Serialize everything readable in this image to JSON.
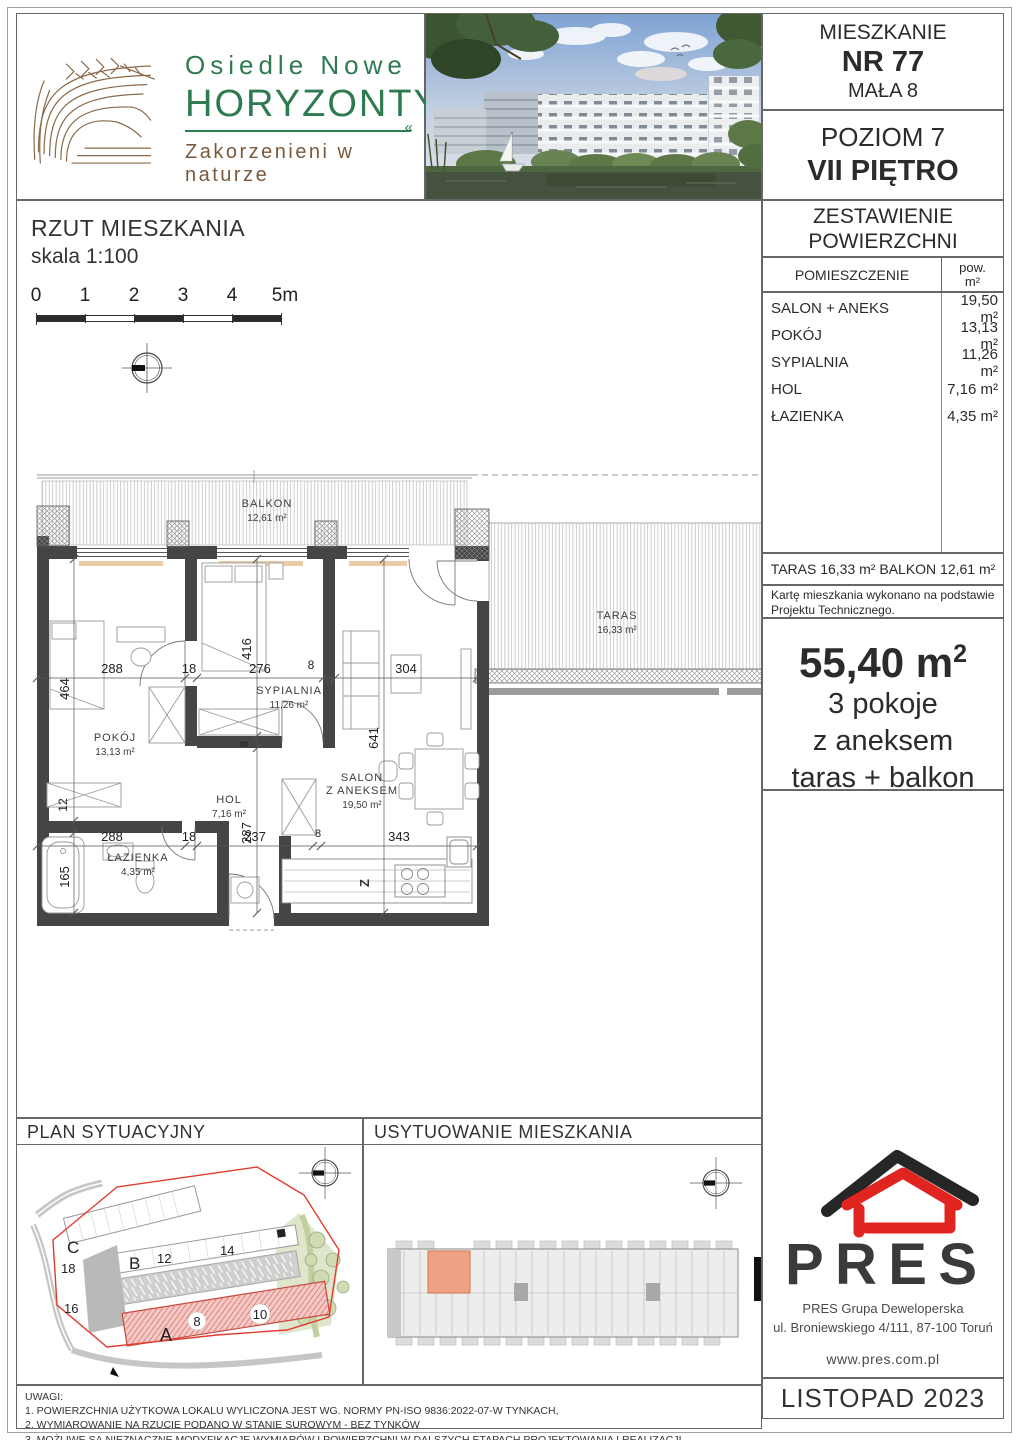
{
  "brand": {
    "name_line1": "Osiedle Nowe",
    "name_line2": "HORYZONTY",
    "divider_mark": "«",
    "tagline": "Zakorzenieni w naturze"
  },
  "header": {
    "apartment_label": "MIESZKANIE",
    "apartment_no": "NR 77",
    "building": "MAŁA 8",
    "level": "POZIOM 7",
    "floor": "VII PIĘTRO"
  },
  "areas": {
    "title1": "ZESTAWIENIE",
    "title2": "POWIERZCHNI",
    "col_room": "POMIESZCZENIE",
    "col_pow": "pow.",
    "col_unit": "m²",
    "rows": [
      {
        "room": "SALON + ANEKS",
        "area": "19,50 m²"
      },
      {
        "room": "POKÓJ",
        "area": "13,13 m²"
      },
      {
        "room": "SYPIALNIA",
        "area": "11,26 m²"
      },
      {
        "room": "HOL",
        "area": "7,16 m²"
      },
      {
        "room": "ŁAZIENKA",
        "area": "4,35 m²"
      }
    ],
    "outdoor": "TARAS 16,33 m²  BALKON 12,61 m²",
    "note": "Kartę mieszkania wykonano na podstawie Projektu Technicznego."
  },
  "summary": {
    "area_value": "55,40 m",
    "area_sup": "2",
    "line2": "3 pokoje",
    "line3": "z aneksem",
    "line4": "taras + balkon"
  },
  "plan": {
    "title": "RZUT MIESZKANIA",
    "scale": "skala 1:100",
    "scalebar": [
      "0",
      "1",
      "2",
      "3",
      "4",
      "5m"
    ],
    "rooms": {
      "balkon_name": "BALKON",
      "balkon_area": "12,61 m²",
      "taras_name": "TARAS",
      "taras_area": "16,33 m²",
      "pokoj_name": "POKÓJ",
      "pokoj_area": "13,13 m²",
      "sypialnia_name": "SYPIALNIA",
      "sypialnia_area": "11,26 m²",
      "salon_name1": "SALON",
      "salon_name2": "Z ANEKSEM",
      "salon_area": "19,50 m²",
      "hol_name": "HOL",
      "hol_area": "7,16 m²",
      "lazienka_name": "ŁAZIENKA",
      "lazienka_area": "4,35 m²"
    },
    "dims": {
      "d288a": "288",
      "d18a": "18",
      "d276": "276",
      "d8a": "8",
      "d304": "304",
      "d464": "464",
      "d416": "416",
      "d641": "641",
      "d12": "12",
      "d165": "165",
      "d287": "287",
      "d8b": "8",
      "d288b": "288",
      "d18b": "18",
      "d237": "237",
      "d8c": "8",
      "d343": "343"
    },
    "kitchen_mark": "Z"
  },
  "site": {
    "title": "PLAN SYTUACYJNY",
    "labels": {
      "A": "A",
      "B": "B",
      "C": "C",
      "n8": "8",
      "n10": "10",
      "n12": "12",
      "n14": "14",
      "n16": "16",
      "n18": "18"
    }
  },
  "location": {
    "title": "USYTUOWANIE MIESZKANIA"
  },
  "developer": {
    "logo": "PRES",
    "company": "PRES Grupa Deweloperska",
    "address": "ul. Broniewskiego 4/111, 87-100 Toruń",
    "website": "www.pres.com.pl",
    "issue_date": "LISTOPAD 2023"
  },
  "notes": {
    "title": "UWAGI:",
    "items": [
      "1. POWIERZCHNIA UŻYTKOWA LOKALU WYLICZONA JEST WG. NORMY PN-ISO 9836:2022-07-W TYNKACH,",
      "2. WYMIAROWANIE NA RZUCIE PODANO W STANIE SUROWYM - BEZ TYNKÓW",
      "3. MOŻLIWE SĄ NIEZNACZNE MODYFIKACJE WYMIARÓW I POWIERZCHNI W DALSZYCH ETAPACH PROJEKTOWANIA I REALIZACJI"
    ]
  },
  "colors": {
    "brand_green": "#2e7b50",
    "brand_brown": "#8a6a4a",
    "pres_red": "#e02420",
    "pres_dark": "#3a3a3c",
    "highlight_salmon": "#efa184",
    "site_pink": "#f5c9c6",
    "boundary_red": "#e23a2e"
  }
}
